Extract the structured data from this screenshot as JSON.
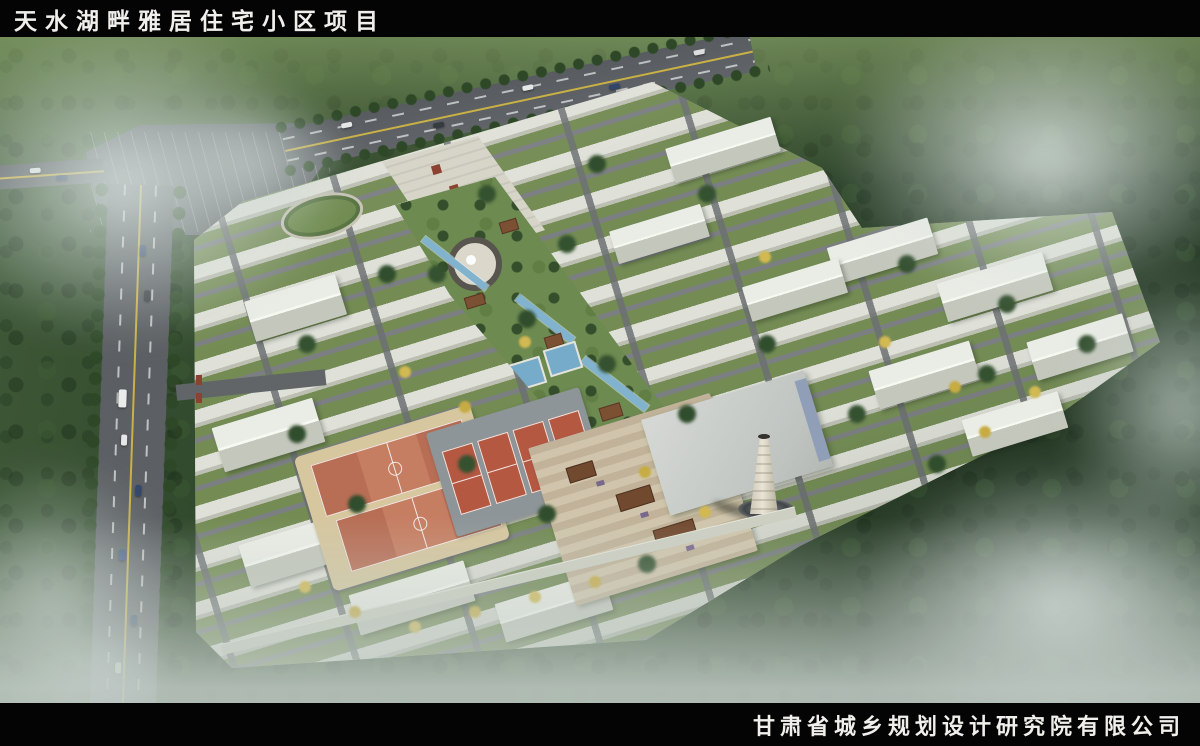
{
  "header": {
    "title": "天水湖畔雅居住宅小区项目"
  },
  "footer": {
    "company": "甘肃省城乡规划设计研究院有限公司"
  },
  "scene": {
    "kind": "aerial-masterplan-rendering",
    "description": "鸟瞰效果图：雾气环绕的山林中的低层住宅小区，西侧与北侧为城市道路，内设中央景观轴、喷泉广场、篮球场、网球场、商业院落与锅炉房烟囱",
    "counts": {
      "basketball_courts": 2,
      "tennis_courts": 4
    },
    "colors": {
      "forest_dark": "#24391f",
      "forest_light": "#6f8a55",
      "mist": "#ccd8d3",
      "road": "#56595d",
      "lane_line_yellow": "#d8b93c",
      "building_roof": "#e8e9e1",
      "lawn": "#6d8c4b",
      "water": "#7fb3d0",
      "basketball_court": "#b96a50",
      "tennis_court": "#b5533c",
      "court_apron": "#d8c89e",
      "chimney": "#ded8c8",
      "autumn_tree": "#d4b94c"
    }
  }
}
